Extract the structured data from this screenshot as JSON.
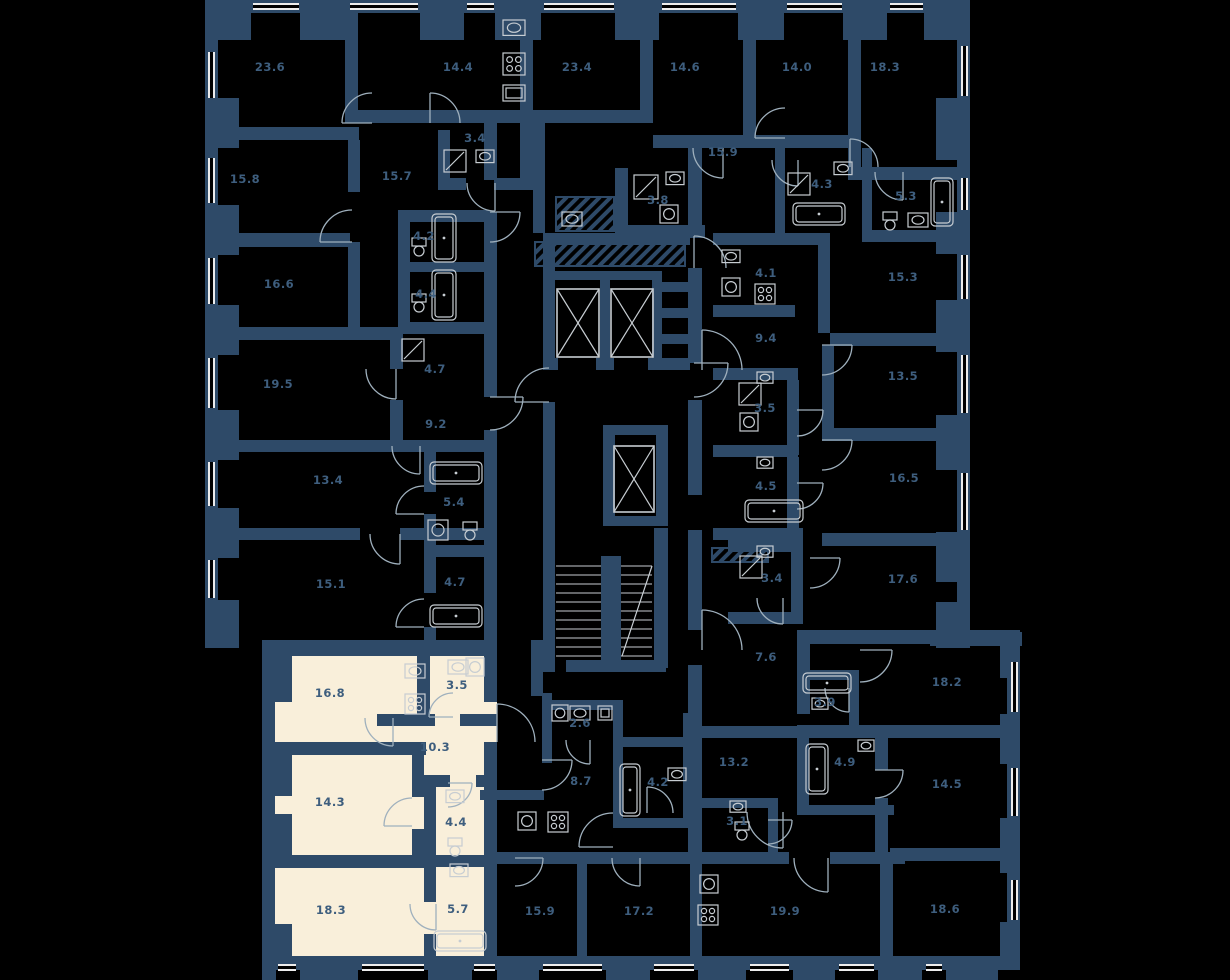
{
  "page": {
    "type": "residential-floor-plan",
    "background": "#000000"
  },
  "palette": {
    "wall": "#2e4a68",
    "room_fill": "#000000",
    "highlight_fill": "#f9efda",
    "label": "#3e5e7e",
    "fixture": "#c7cdd2",
    "window": "#ececec",
    "door": "#9fb0bd"
  },
  "highlighted_apartment": {
    "name": "selected-apartment",
    "rooms": [
      {
        "area": "16.8",
        "x": 330,
        "y": 697
      },
      {
        "area": "3.5",
        "x": 457,
        "y": 689
      },
      {
        "area": "10.3",
        "x": 435,
        "y": 751
      },
      {
        "area": "14.3",
        "x": 330,
        "y": 806
      },
      {
        "area": "4.4",
        "x": 456,
        "y": 826
      },
      {
        "area": "18.3",
        "x": 331,
        "y": 914
      },
      {
        "area": "5.7",
        "x": 458,
        "y": 913
      }
    ]
  },
  "other_rooms": [
    {
      "area": "23.6",
      "x": 270,
      "y": 71
    },
    {
      "area": "14.4",
      "x": 458,
      "y": 71
    },
    {
      "area": "23.4",
      "x": 577,
      "y": 71
    },
    {
      "area": "14.6",
      "x": 685,
      "y": 71
    },
    {
      "area": "14.0",
      "x": 797,
      "y": 71
    },
    {
      "area": "18.3",
      "x": 885,
      "y": 71
    },
    {
      "area": "15.8",
      "x": 245,
      "y": 183
    },
    {
      "area": "15.7",
      "x": 397,
      "y": 180
    },
    {
      "area": "3.4",
      "x": 475,
      "y": 142
    },
    {
      "area": "15.9",
      "x": 723,
      "y": 156
    },
    {
      "area": "3.8",
      "x": 658,
      "y": 204
    },
    {
      "area": "4.3",
      "x": 822,
      "y": 188
    },
    {
      "area": "5.3",
      "x": 906,
      "y": 200
    },
    {
      "area": "4.2",
      "x": 424,
      "y": 240
    },
    {
      "area": "4.4",
      "x": 426,
      "y": 298
    },
    {
      "area": "16.6",
      "x": 279,
      "y": 288
    },
    {
      "area": "4.1",
      "x": 766,
      "y": 277
    },
    {
      "area": "15.3",
      "x": 903,
      "y": 281
    },
    {
      "area": "9.4",
      "x": 766,
      "y": 342
    },
    {
      "area": "13.5",
      "x": 903,
      "y": 380
    },
    {
      "area": "19.5",
      "x": 278,
      "y": 388
    },
    {
      "area": "4.7",
      "x": 435,
      "y": 373
    },
    {
      "area": "3.5",
      "x": 765,
      "y": 412
    },
    {
      "area": "9.2",
      "x": 436,
      "y": 428
    },
    {
      "area": "16.5",
      "x": 904,
      "y": 482
    },
    {
      "area": "4.5",
      "x": 766,
      "y": 490
    },
    {
      "area": "13.4",
      "x": 328,
      "y": 484
    },
    {
      "area": "5.4",
      "x": 454,
      "y": 506
    },
    {
      "area": "15.1",
      "x": 331,
      "y": 588
    },
    {
      "area": "4.7",
      "x": 455,
      "y": 586
    },
    {
      "area": "3.4",
      "x": 772,
      "y": 582
    },
    {
      "area": "17.6",
      "x": 903,
      "y": 583
    },
    {
      "area": "7.6",
      "x": 766,
      "y": 661
    },
    {
      "area": "18.2",
      "x": 947,
      "y": 686
    },
    {
      "area": "3.9",
      "x": 825,
      "y": 706
    },
    {
      "area": "2.6",
      "x": 580,
      "y": 727
    },
    {
      "area": "8.7",
      "x": 581,
      "y": 785
    },
    {
      "area": "4.2",
      "x": 658,
      "y": 786
    },
    {
      "area": "13.2",
      "x": 734,
      "y": 766
    },
    {
      "area": "3.1",
      "x": 737,
      "y": 825
    },
    {
      "area": "4.9",
      "x": 845,
      "y": 766
    },
    {
      "area": "14.5",
      "x": 947,
      "y": 788
    },
    {
      "area": "15.9",
      "x": 540,
      "y": 915
    },
    {
      "area": "17.2",
      "x": 639,
      "y": 915
    },
    {
      "area": "19.9",
      "x": 785,
      "y": 915
    },
    {
      "area": "18.6",
      "x": 945,
      "y": 913
    }
  ],
  "core": {
    "elevators": 3,
    "staircase": true
  }
}
